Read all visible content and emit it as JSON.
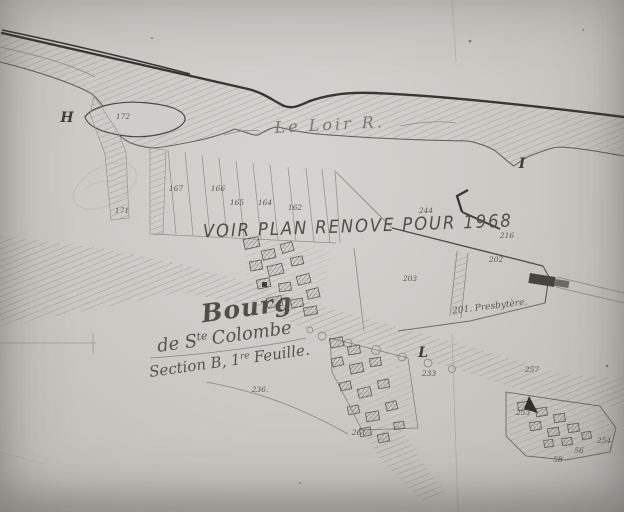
{
  "map": {
    "overlay_note": "VOIR PLAN RENOVE POUR 1968",
    "river_label": "Le Loir R.",
    "title": {
      "line1": "Bourg",
      "line2_pre": "de S",
      "line2_sup": "te",
      "line2_post": "Colombe",
      "line3_pre": "Section B, 1",
      "line3_sup": "re",
      "line3_post": "Feuille."
    },
    "presbytery_label": "201. Presbytère.",
    "section_letters": [
      {
        "label": "H",
        "x": 67,
        "y": 122
      },
      {
        "label": "I",
        "x": 522,
        "y": 168
      },
      {
        "label": "L",
        "x": 423,
        "y": 357
      }
    ],
    "parcel_numbers": [
      {
        "label": "172",
        "x": 123,
        "y": 119
      },
      {
        "label": "171",
        "x": 122,
        "y": 213
      },
      {
        "label": "167",
        "x": 176,
        "y": 191
      },
      {
        "label": "166",
        "x": 218,
        "y": 191
      },
      {
        "label": "165",
        "x": 237,
        "y": 205
      },
      {
        "label": "164",
        "x": 265,
        "y": 205
      },
      {
        "label": "162",
        "x": 295,
        "y": 210
      },
      {
        "label": "244",
        "x": 426,
        "y": 213
      },
      {
        "label": "216",
        "x": 507,
        "y": 238
      },
      {
        "label": "202",
        "x": 496,
        "y": 262
      },
      {
        "label": "203",
        "x": 410,
        "y": 281
      },
      {
        "label": "233",
        "x": 429,
        "y": 376
      },
      {
        "label": "236.",
        "x": 260,
        "y": 392
      },
      {
        "label": "261",
        "x": 359,
        "y": 435
      },
      {
        "label": "257",
        "x": 532,
        "y": 372
      },
      {
        "label": "253",
        "x": 523,
        "y": 415
      },
      {
        "label": "254",
        "x": 604,
        "y": 443
      },
      {
        "label": "56",
        "x": 579,
        "y": 453
      },
      {
        "label": "58",
        "x": 558,
        "y": 462
      }
    ],
    "colors": {
      "paper": "#ccc9c5",
      "ink": "#504e48",
      "hatch": "#96948e"
    }
  }
}
